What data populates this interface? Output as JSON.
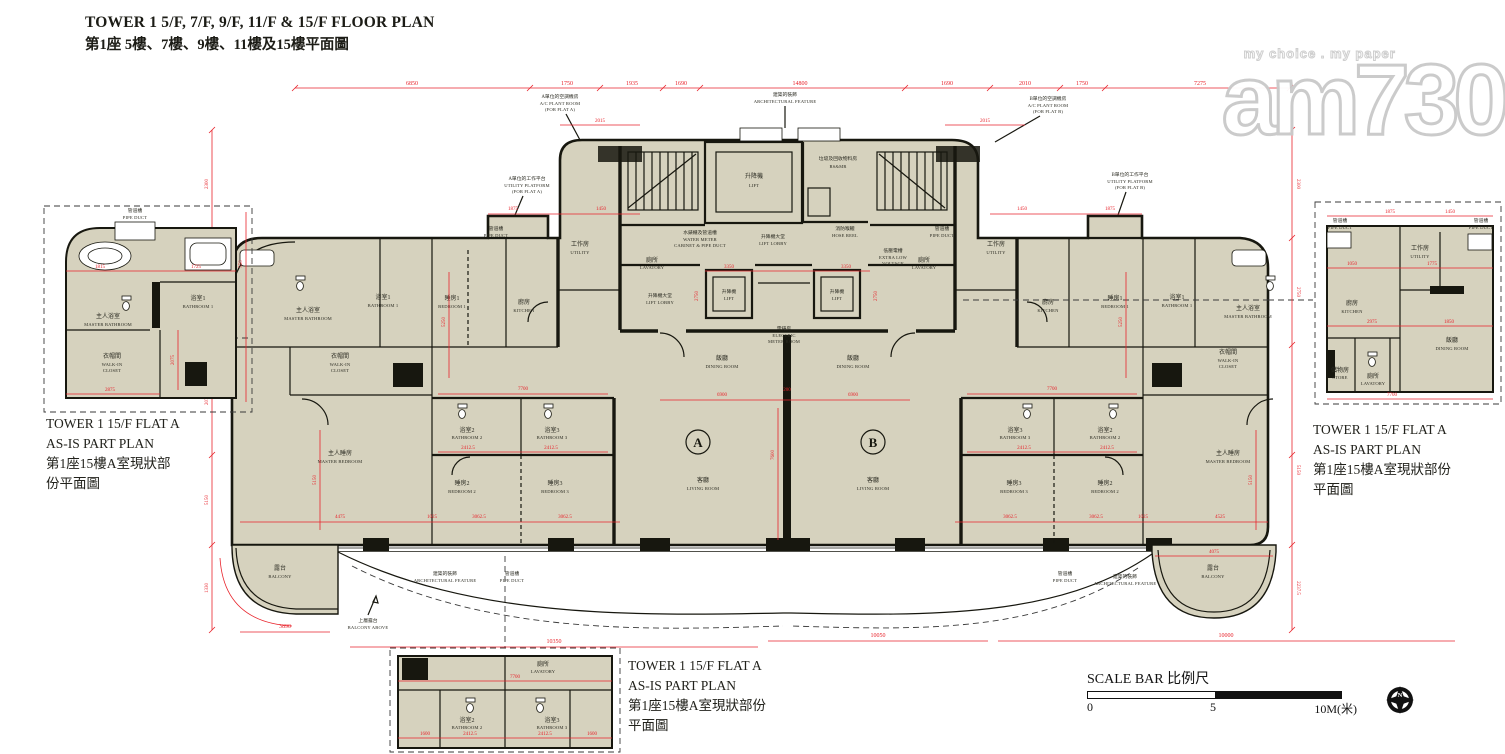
{
  "header": {
    "title_en": "TOWER 1 5/F, 7/F, 9/F, 11/F & 15/F FLOOR PLAN",
    "title_zh": "第1座 5樓、7樓、9樓、11樓及15樓平面圖"
  },
  "watermark": {
    "tagline": "my choice . my paper",
    "logo": "am730"
  },
  "captions": {
    "left": {
      "l1": "TOWER 1 15/F FLAT A",
      "l2": "AS-IS PART PLAN",
      "l3": "第1座15樓A室現狀部",
      "l4": "份平面圖"
    },
    "right": {
      "l1": "TOWER 1 15/F FLAT A",
      "l2": "AS-IS PART PLAN",
      "l3": "第1座15樓A室現狀部份",
      "l4": "平面圖"
    },
    "bottom": {
      "l1": "TOWER 1 15/F FLAT A",
      "l2": "AS-IS PART PLAN",
      "l3": "第1座15樓A室現狀部份",
      "l4": "平面圖"
    }
  },
  "scale_bar": {
    "title": "SCALE BAR 比例尺",
    "t0": "0",
    "t5": "5",
    "t10": "10M(米)"
  },
  "compass": {
    "n": "N"
  },
  "units": {
    "a": "A",
    "b": "B"
  },
  "labels": {
    "dining": {
      "zh": "飯廳",
      "en": "DINING ROOM"
    },
    "living": {
      "zh": "客廳",
      "en": "LIVING ROOM"
    },
    "kitchen": {
      "zh": "廚房",
      "en": "KITCHEN"
    },
    "bedroom1": {
      "zh": "睡房1",
      "en": "BEDROOM 1"
    },
    "bedroom2": {
      "zh": "睡房2",
      "en": "BEDROOM 2"
    },
    "bedroom3": {
      "zh": "睡房3",
      "en": "BEDROOM 3"
    },
    "master_bedroom": {
      "zh": "主人睡房",
      "en": "MASTER BEDROOM"
    },
    "master_bathroom": {
      "zh": "主人浴室",
      "en": "MASTER BATHROOM"
    },
    "bathroom1": {
      "zh": "浴室1",
      "en": "BATHROOM 1"
    },
    "bathroom2": {
      "zh": "浴室2",
      "en": "BATHROOM 2"
    },
    "bathroom3": {
      "zh": "浴室3",
      "en": "BATHROOM 3"
    },
    "walkin": {
      "zh": "衣帽間",
      "en1": "WALK-IN",
      "en2": "CLOSET"
    },
    "utility": {
      "zh": "工作房",
      "en": "UTILITY"
    },
    "lavatory": {
      "zh": "廁所",
      "en": "LAVATORY"
    },
    "store": {
      "zh": "儲物房",
      "en": "STORE"
    },
    "balcony": {
      "zh": "露台",
      "en": "BALCONY"
    },
    "balcony_above": {
      "zh": "上層露台",
      "en": "BALCONY ABOVE"
    },
    "pipe_duct": {
      "zh": "管道槽",
      "en": "PIPE DUCT"
    },
    "lift": {
      "zh": "升降機",
      "en": "LIFT"
    },
    "lift_lobby": {
      "zh": "升降機大堂",
      "en": "LIFT LOBBY"
    },
    "emr": {
      "zh": "電錶房",
      "en1": "ELECTRIC",
      "en2": "METER ROOM"
    },
    "rsmr": {
      "zh": "垃圾及回收物料房",
      "en": "RS&MR"
    },
    "hose_reel": {
      "zh": "消防喉轆",
      "en": "HOSE REEL"
    },
    "water_meter": {
      "zh": "水錶櫃及管道槽",
      "en1": "WATER METER",
      "en2": "CABINET & PIPE DUCT"
    },
    "elv": {
      "zh": "低壓電槽",
      "en1": "EXTRA LOW",
      "en2": "VOLTAGE"
    },
    "arch_feature": {
      "zh": "建築的裝飾",
      "en": "ARCHITECTURAL FEATURE"
    },
    "ac_plant_a": {
      "zh": "A單位的空調機房",
      "en1": "A/C PLANT ROOM",
      "en2": "(FOR FLAT A)"
    },
    "ac_plant_b": {
      "zh": "B單位的空調機房",
      "en1": "A/C PLANT ROOM",
      "en2": "(FOR FLAT B)"
    },
    "util_platform_a": {
      "zh": "A單位的工作平台",
      "en1": "UTILITY PLATFORM",
      "en2": "(FOR FLAT A)"
    },
    "util_platform_b": {
      "zh": "B單位的工作平台",
      "en1": "UTILITY PLATFORM",
      "en2": "(FOR FLAT B)"
    }
  },
  "dims": {
    "d6850": "6850",
    "d1750": "1750",
    "d1935": "1935",
    "d1690": "1690",
    "d14800": "14800",
    "d2010": "2010",
    "d7275": "7275",
    "d2015": "2015",
    "d2300": "2300",
    "d2750": "2750",
    "d2075": "2075",
    "d5150": "5150",
    "d1330": "1330",
    "d2237_5": "2237.5",
    "d3890": "3890",
    "d10350": "10350",
    "d10050": "10050",
    "d10000": "10000",
    "d6900": "6900",
    "d200": "200",
    "d7600": "7600",
    "d7700": "7700",
    "d4475": "4475",
    "d4525": "4525",
    "d1025": "1025",
    "d3062_5": "3062.5",
    "d2412_5": "2412.5",
    "d5250": "5250",
    "d3350": "3350",
    "d1875": "1875",
    "d1450": "1450",
    "d4075": "4075",
    "d1815": "1815",
    "d1725": "1725",
    "d2875": "2875",
    "d1050": "1050",
    "d1775": "1775",
    "d2975": "2975",
    "d1850": "1850",
    "d550": "550",
    "d1600": "1600"
  },
  "colors": {
    "dimension_red": "#e8232b",
    "wall_black": "#17170f",
    "floor_beige": "#d6d2be"
  }
}
